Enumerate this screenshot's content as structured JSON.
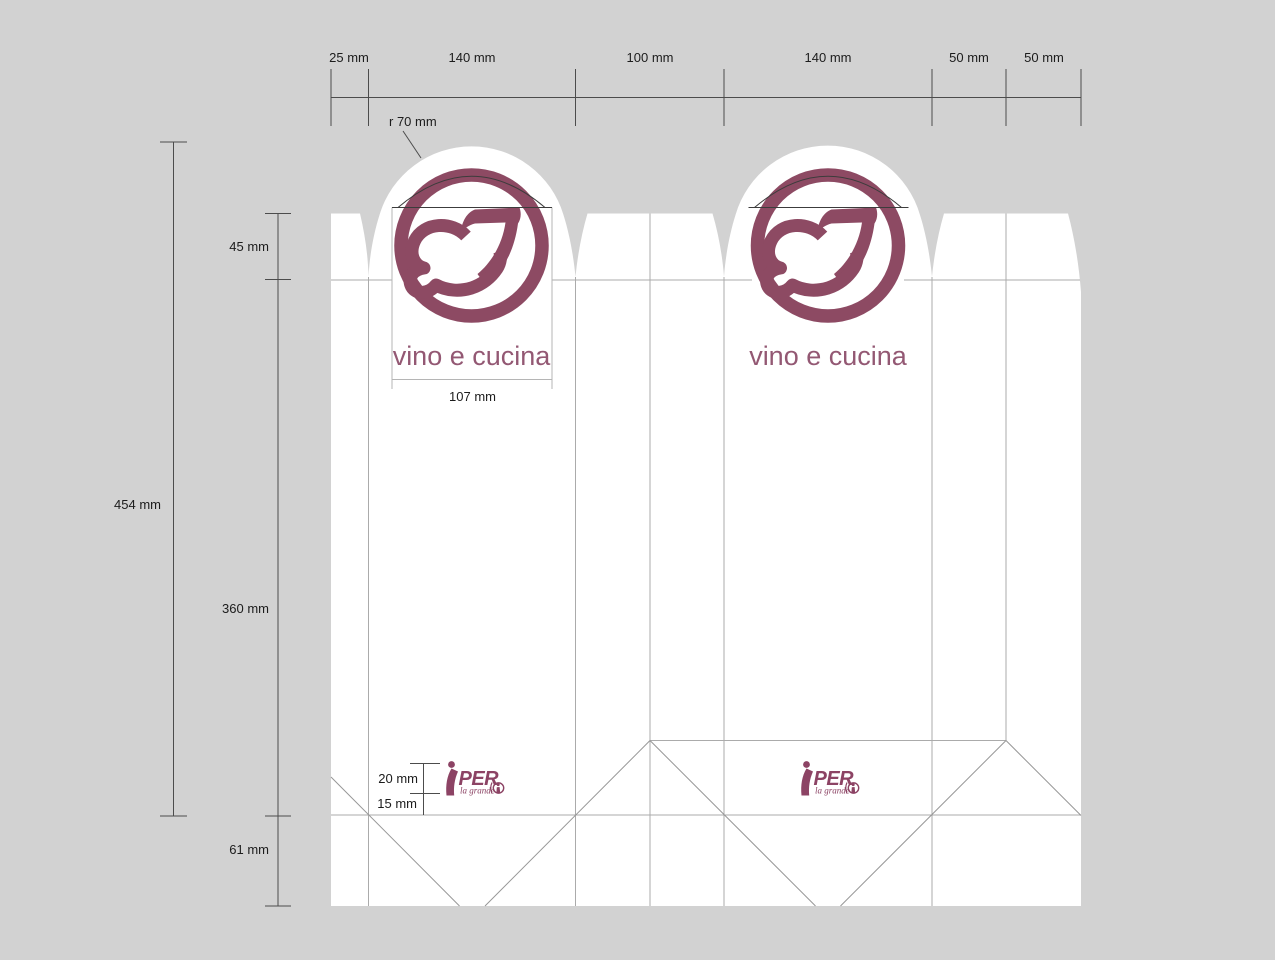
{
  "top_dimensions": {
    "labels": [
      "25 mm",
      "140 mm",
      "100 mm",
      "140 mm",
      "50 mm",
      "50 mm"
    ]
  },
  "side_dimensions": {
    "total": "454 mm",
    "top_section": "45 mm",
    "middle_section": "360 mm",
    "bottom_section": "61 mm"
  },
  "detail_dimensions": {
    "tab_radius": "r 70 mm",
    "logo_area_width": "107 mm",
    "retail_logo_height": "20 mm",
    "retail_logo_margin": "15 mm"
  },
  "branding": {
    "numeral": "27",
    "wordmark": "vino e cucina",
    "retailer_text": "PER",
    "retailer_tagline": "la grande"
  },
  "colors": {
    "background": "#d2d2d2",
    "paper": "#ffffff",
    "brand_maroon": "#8d4a63",
    "wordmark_color": "#935873",
    "retailer_color": "#8c4364",
    "dimension_line": "#4c4c4c",
    "crease_line": "#ababab",
    "diagonal_fold_line": "#979797"
  }
}
